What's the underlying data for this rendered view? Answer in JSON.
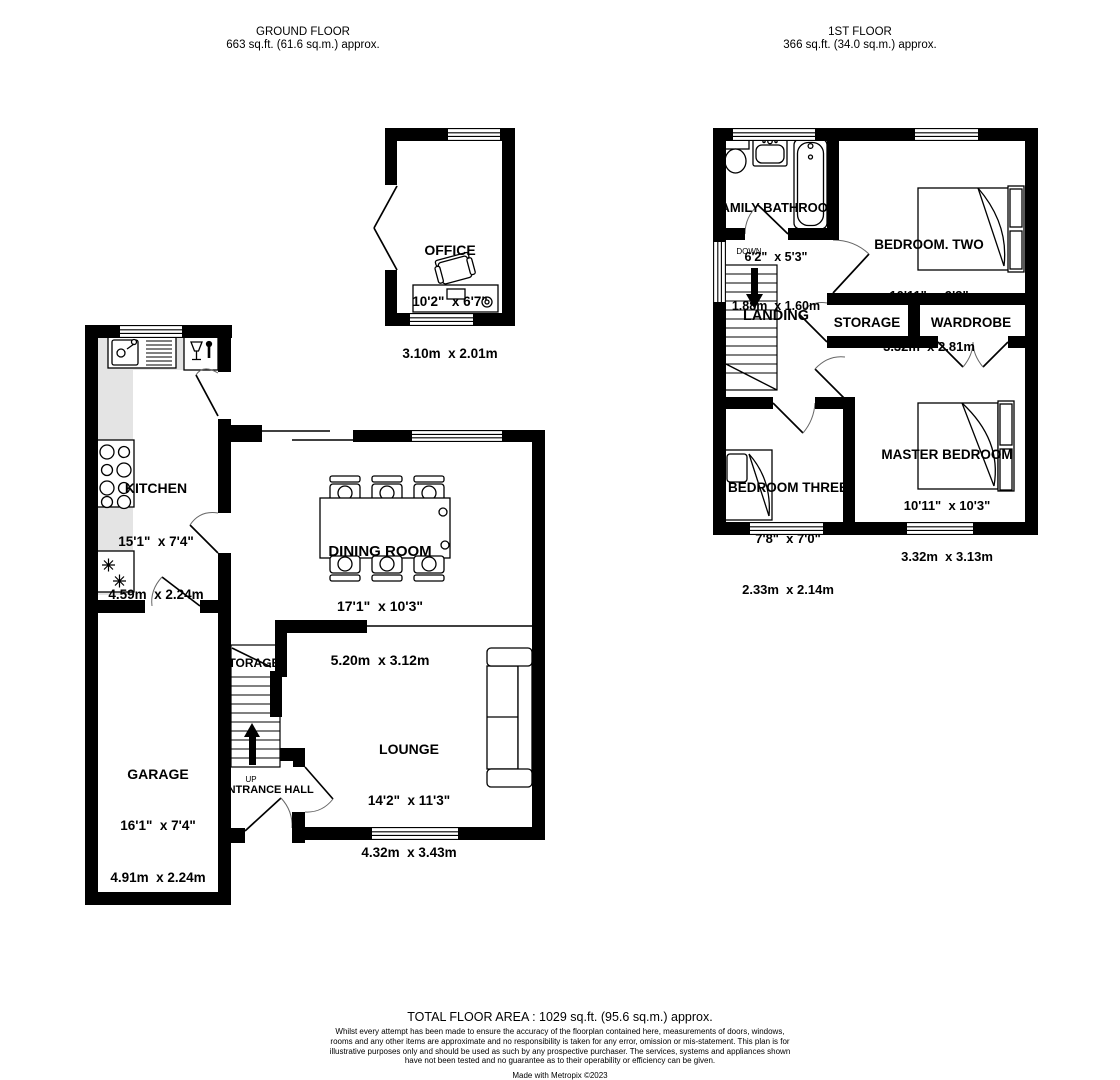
{
  "headers": {
    "ground_floor": {
      "title": "GROUND FLOOR",
      "area": "663 sq.ft. (61.6 sq.m.) approx."
    },
    "first_floor": {
      "title": "1ST FLOOR",
      "area": "366 sq.ft. (34.0 sq.m.) approx."
    }
  },
  "rooms": {
    "office": {
      "name": "OFFICE",
      "imperial": "10'2\"  x 6'7\"",
      "metric": "3.10m  x 2.01m"
    },
    "kitchen": {
      "name": "KITCHEN",
      "imperial": "15'1\"  x 7'4\"",
      "metric": "4.59m  x 2.24m"
    },
    "dining_room": {
      "name": "DINING ROOM",
      "imperial": "17'1\"  x 10'3\"",
      "metric": "5.20m  x 3.12m"
    },
    "garage": {
      "name": "GARAGE",
      "imperial": "16'1\"  x 7'4\"",
      "metric": "4.91m  x 2.24m"
    },
    "lounge": {
      "name": "LOUNGE",
      "imperial": "14'2\"  x 11'3\"",
      "metric": "4.32m  x 3.43m"
    },
    "family_bathroom": {
      "name": "FAMILY BATHROOM",
      "imperial": "6'2\"  x 5'3\"",
      "metric": "1.88m  x 1.60m"
    },
    "bedroom_two": {
      "name": "BEDROOM. TWO",
      "imperial": "10'11\"  x 9'3\"",
      "metric": "3.32m  x 2.81m"
    },
    "bedroom_three": {
      "name": "BEDROOM THREE",
      "imperial": "7'8\"  x 7'0\"",
      "metric": "2.33m  x 2.14m"
    },
    "master_bedroom": {
      "name": "MASTER BEDROOM",
      "imperial": "10'11\"  x 10'3\"",
      "metric": "3.32m  x 3.13m"
    }
  },
  "labels": {
    "storage_ground": "STORAGE",
    "up": "UP",
    "entrance_hall": "ENTRANCE HALL",
    "down": "DOWN",
    "landing": "LANDING",
    "storage_first": "STORAGE",
    "wardrobe": "WARDROBE"
  },
  "footer": {
    "total_area": "TOTAL FLOOR AREA : 1029 sq.ft. (95.6 sq.m.) approx.",
    "disclaimer": "Whilst every attempt has been made to ensure the accuracy of the floorplan contained here, measurements of doors, windows, rooms and any other items are approximate and no responsibility is taken for any error, omission or mis-statement. This plan is for illustrative purposes only and should be used as such by any prospective purchaser. The services, systems and appliances shown have not been tested and no guarantee as to their operability or efficiency can be given.",
    "madewith": "Made with Metropix ©2023"
  },
  "colors": {
    "wall": "#000000",
    "counter": "#e4e4e4",
    "background": "#ffffff"
  },
  "icons": [
    "sink-icon",
    "glass-cabinet-icon",
    "hob-icon",
    "fridge-snowflake-icon",
    "toilet-icon",
    "basin-icon",
    "bathtub-icon",
    "bed-icon",
    "sofa-icon",
    "desk-icon",
    "chair-icon",
    "stairs-up-arrow-icon",
    "stairs-down-arrow-icon"
  ]
}
